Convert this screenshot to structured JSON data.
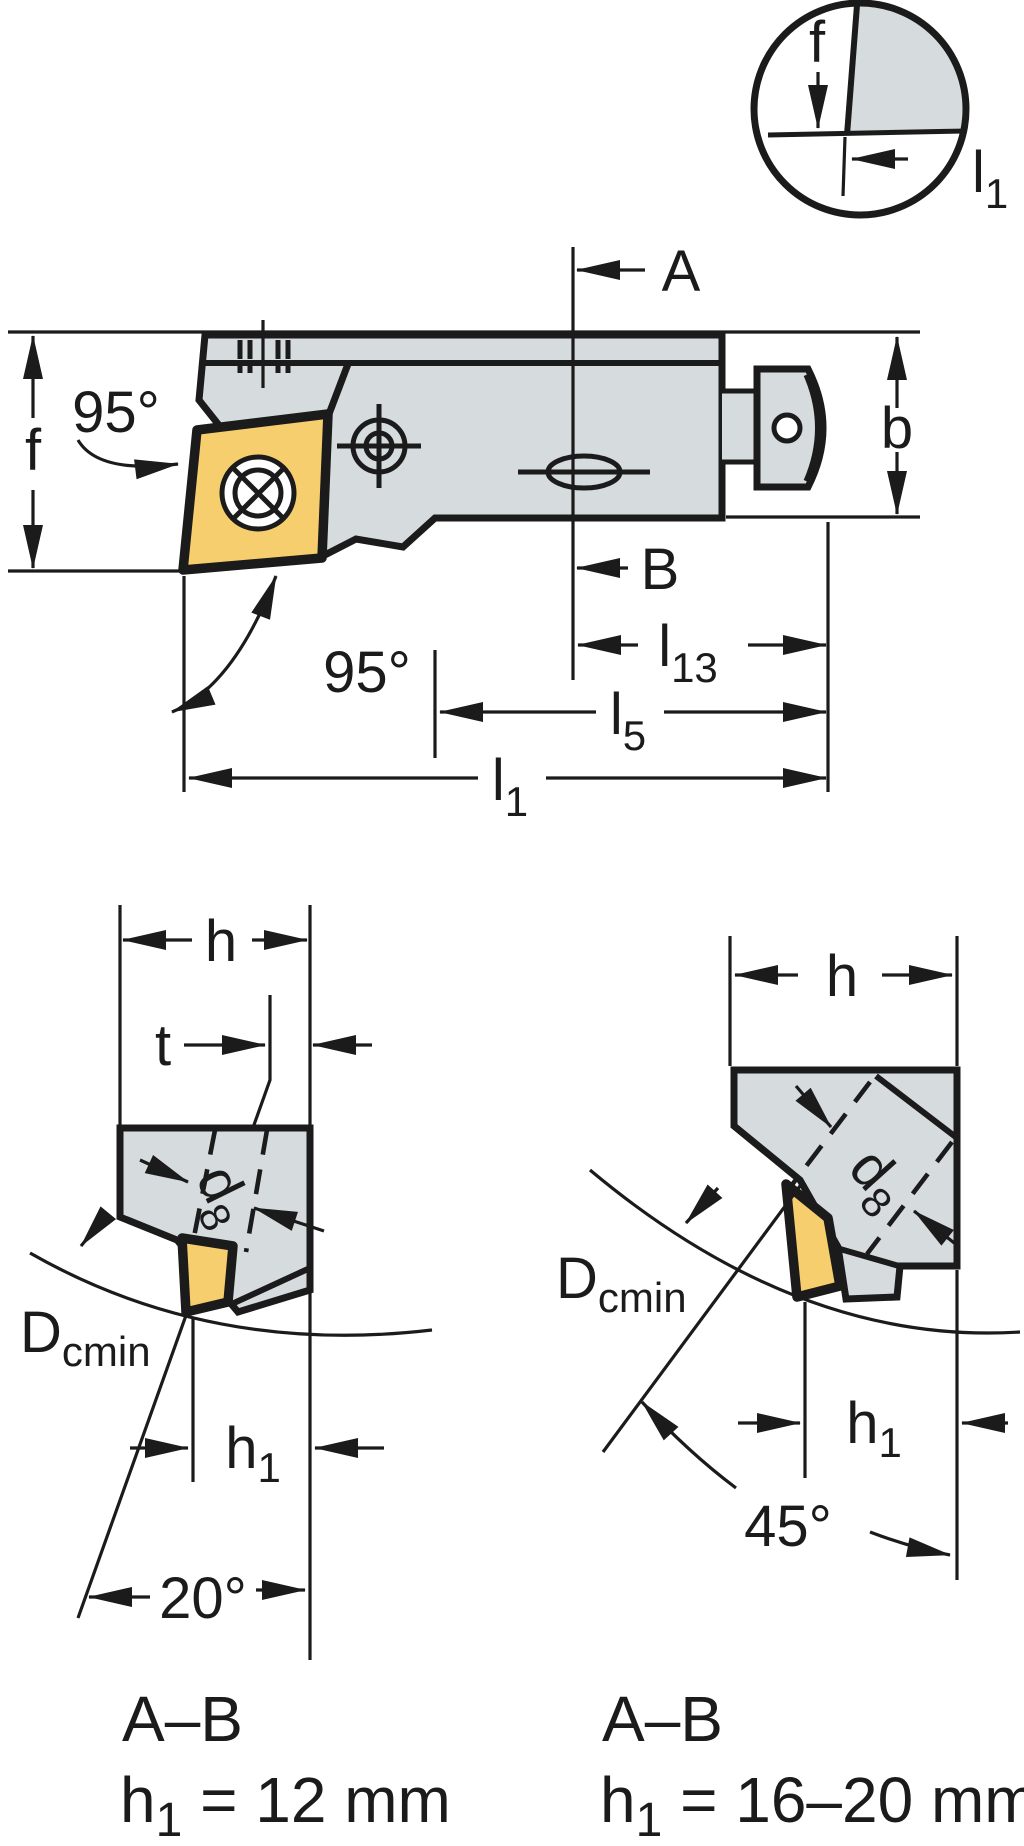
{
  "colors": {
    "background": "#ffffff",
    "line": "#1b1b1b",
    "tool_body": "#d6dbde",
    "insert": "#f6ce6e"
  },
  "detail_circle": {
    "f_label": "f",
    "l1_label": {
      "base": "l",
      "sub": "1"
    }
  },
  "main_view": {
    "section_label_a": "A",
    "section_label_b": "B",
    "f_label": "f",
    "b_label": "b",
    "front_angle_label": "95°",
    "pocket_angle_label": "95°",
    "l13_label": {
      "base": "l",
      "sub": "13"
    },
    "l5_label": {
      "base": "l",
      "sub": "5"
    },
    "l1_label": {
      "base": "l",
      "sub": "1"
    }
  },
  "section_view_left": {
    "h_label": "h",
    "t_label": "t",
    "d8_label": {
      "base": "d",
      "sub": "8"
    },
    "dcmin_label": {
      "base": "D",
      "sub": "cmin"
    },
    "h1_label": {
      "base": "h",
      "sub": "1"
    },
    "angle_label": "20°",
    "caption": "A–B",
    "spec": {
      "base": "h",
      "sub": "1",
      "rest": " = 12 mm"
    }
  },
  "section_view_right": {
    "h_label": "h",
    "d8_label": {
      "base": "d",
      "sub": "8"
    },
    "dcmin_label": {
      "base": "D",
      "sub": "cmin"
    },
    "h1_label": {
      "base": "h",
      "sub": "1"
    },
    "angle_label": "45°",
    "caption": "A–B",
    "spec": {
      "base": "h",
      "sub": "1",
      "rest": " = 16–20 mm"
    }
  }
}
